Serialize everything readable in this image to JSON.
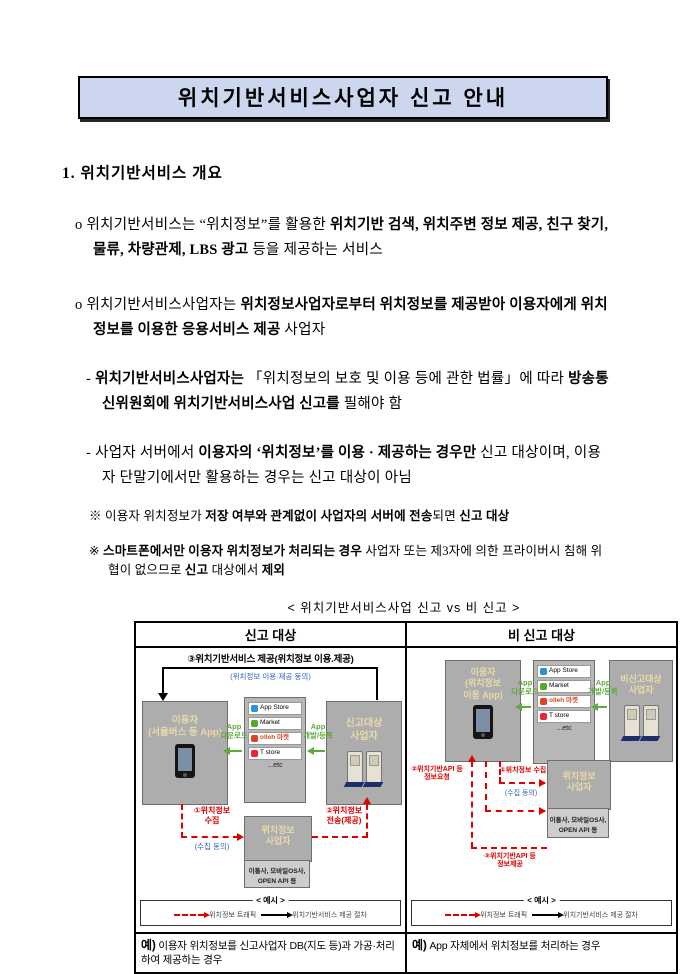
{
  "title": "위치기반서비스사업자 신고 안내",
  "section1": {
    "heading": "1. 위치기반서비스 개요"
  },
  "paragraphs": {
    "p1": {
      "bullet": "o",
      "s1": "위치기반서비스는 “위치정보”를 활용한 ",
      "s2": "위치기반 검색, 위치주변 정보 제공, 친구 찾기, 물류, 차량관제, LBS 광고",
      "s3": " 등을 제공하는 서비스"
    },
    "p2": {
      "bullet": "o",
      "s1": "위치기반서비스사업자는 ",
      "s2": "위치정보사업자로부터 위치정보를 제공받아 이용자에게 위치정보를 이용한 응용서비스 제공",
      "s3": " 사업자"
    },
    "p3": {
      "bullet": "-",
      "s1": "위치기반서비스사업자는",
      "s2": " 「위치정보의 보호 및 이용 등에 관한 법률」에 따라 ",
      "s3": "방송통신위원회에 위치기반서비스사업 신고를",
      "s4": " 필해야 함"
    },
    "p4": {
      "bullet": "-",
      "s1": "사업자 서버에서 ",
      "s2": "이용자의 ‘위치정보’를 이용 · 제공하는 경우만",
      "s3": " 신고 대상이며, 이용자 단말기에서만 활용하는 경우는 신고 대상이 아님"
    },
    "n1": {
      "bullet": "※",
      "s1": "이용자 위치정보가 ",
      "s2": "저장 여부와 관계없이 사업자의 서버에 전송",
      "s3": "되면 ",
      "s4": "신고 대상"
    },
    "n2": {
      "bullet": "※",
      "s1": "스마트폰에서만 이용자 위치정보가 처리되는 경우",
      "s2": " 사업자 또는 제3자에 의한 프라이버시 침해 위협이 없으므로 ",
      "s3": "신고",
      "s4": " 대상에서 ",
      "s5": "제외"
    }
  },
  "diagram": {
    "caption": "< 위치기반서비스사업 신고 vs 비 신고 >",
    "left_header": "신고 대상",
    "right_header": "비 신고 대상",
    "badges": {
      "b1": "App Store",
      "b2": "Market",
      "b3": "olleh 마켓",
      "b4": "T store",
      "etc": "...etc"
    },
    "arrow_dl": "App\n다운로드",
    "arrow_reg": "App\n개발/등록",
    "consent": "(수집 동의)",
    "lip": "위치정보\n사업자",
    "lip_sub": "이통사, 모바일OS사,\nOPEN API 등",
    "legend": {
      "title": "< 예시 >",
      "red": "위치정보 트래픽",
      "black": "위치기반서비스 제공 절차"
    },
    "left": {
      "top_label": "③위치기반서비스 제공(위치정보 이용.제공)",
      "top_note": "(위치정보 이용·제공 동의)",
      "user": "이용자\n(서울버스 등 App)",
      "provider": "신고대상\n사업자",
      "collect": "①위치정보\n수집",
      "transfer": "②위치정보\n전송(제공)",
      "example_prefix": "예)",
      "example": " 이용자 위치정보를 신고사업자 DB(지도 등)과 가공·처리하여 제공하는 경우"
    },
    "right": {
      "user": "이용자\n(위치정보\n이용 App)",
      "provider": "비신고대상\n사업자",
      "request": "②위치기반API 등\n정보요청",
      "collect": "①위치정보 수집",
      "provide": "③위치기반API 등\n정보제공",
      "example_prefix": "예)",
      "example": " App 자체에서 위치정보를 처리하는 경우"
    }
  }
}
